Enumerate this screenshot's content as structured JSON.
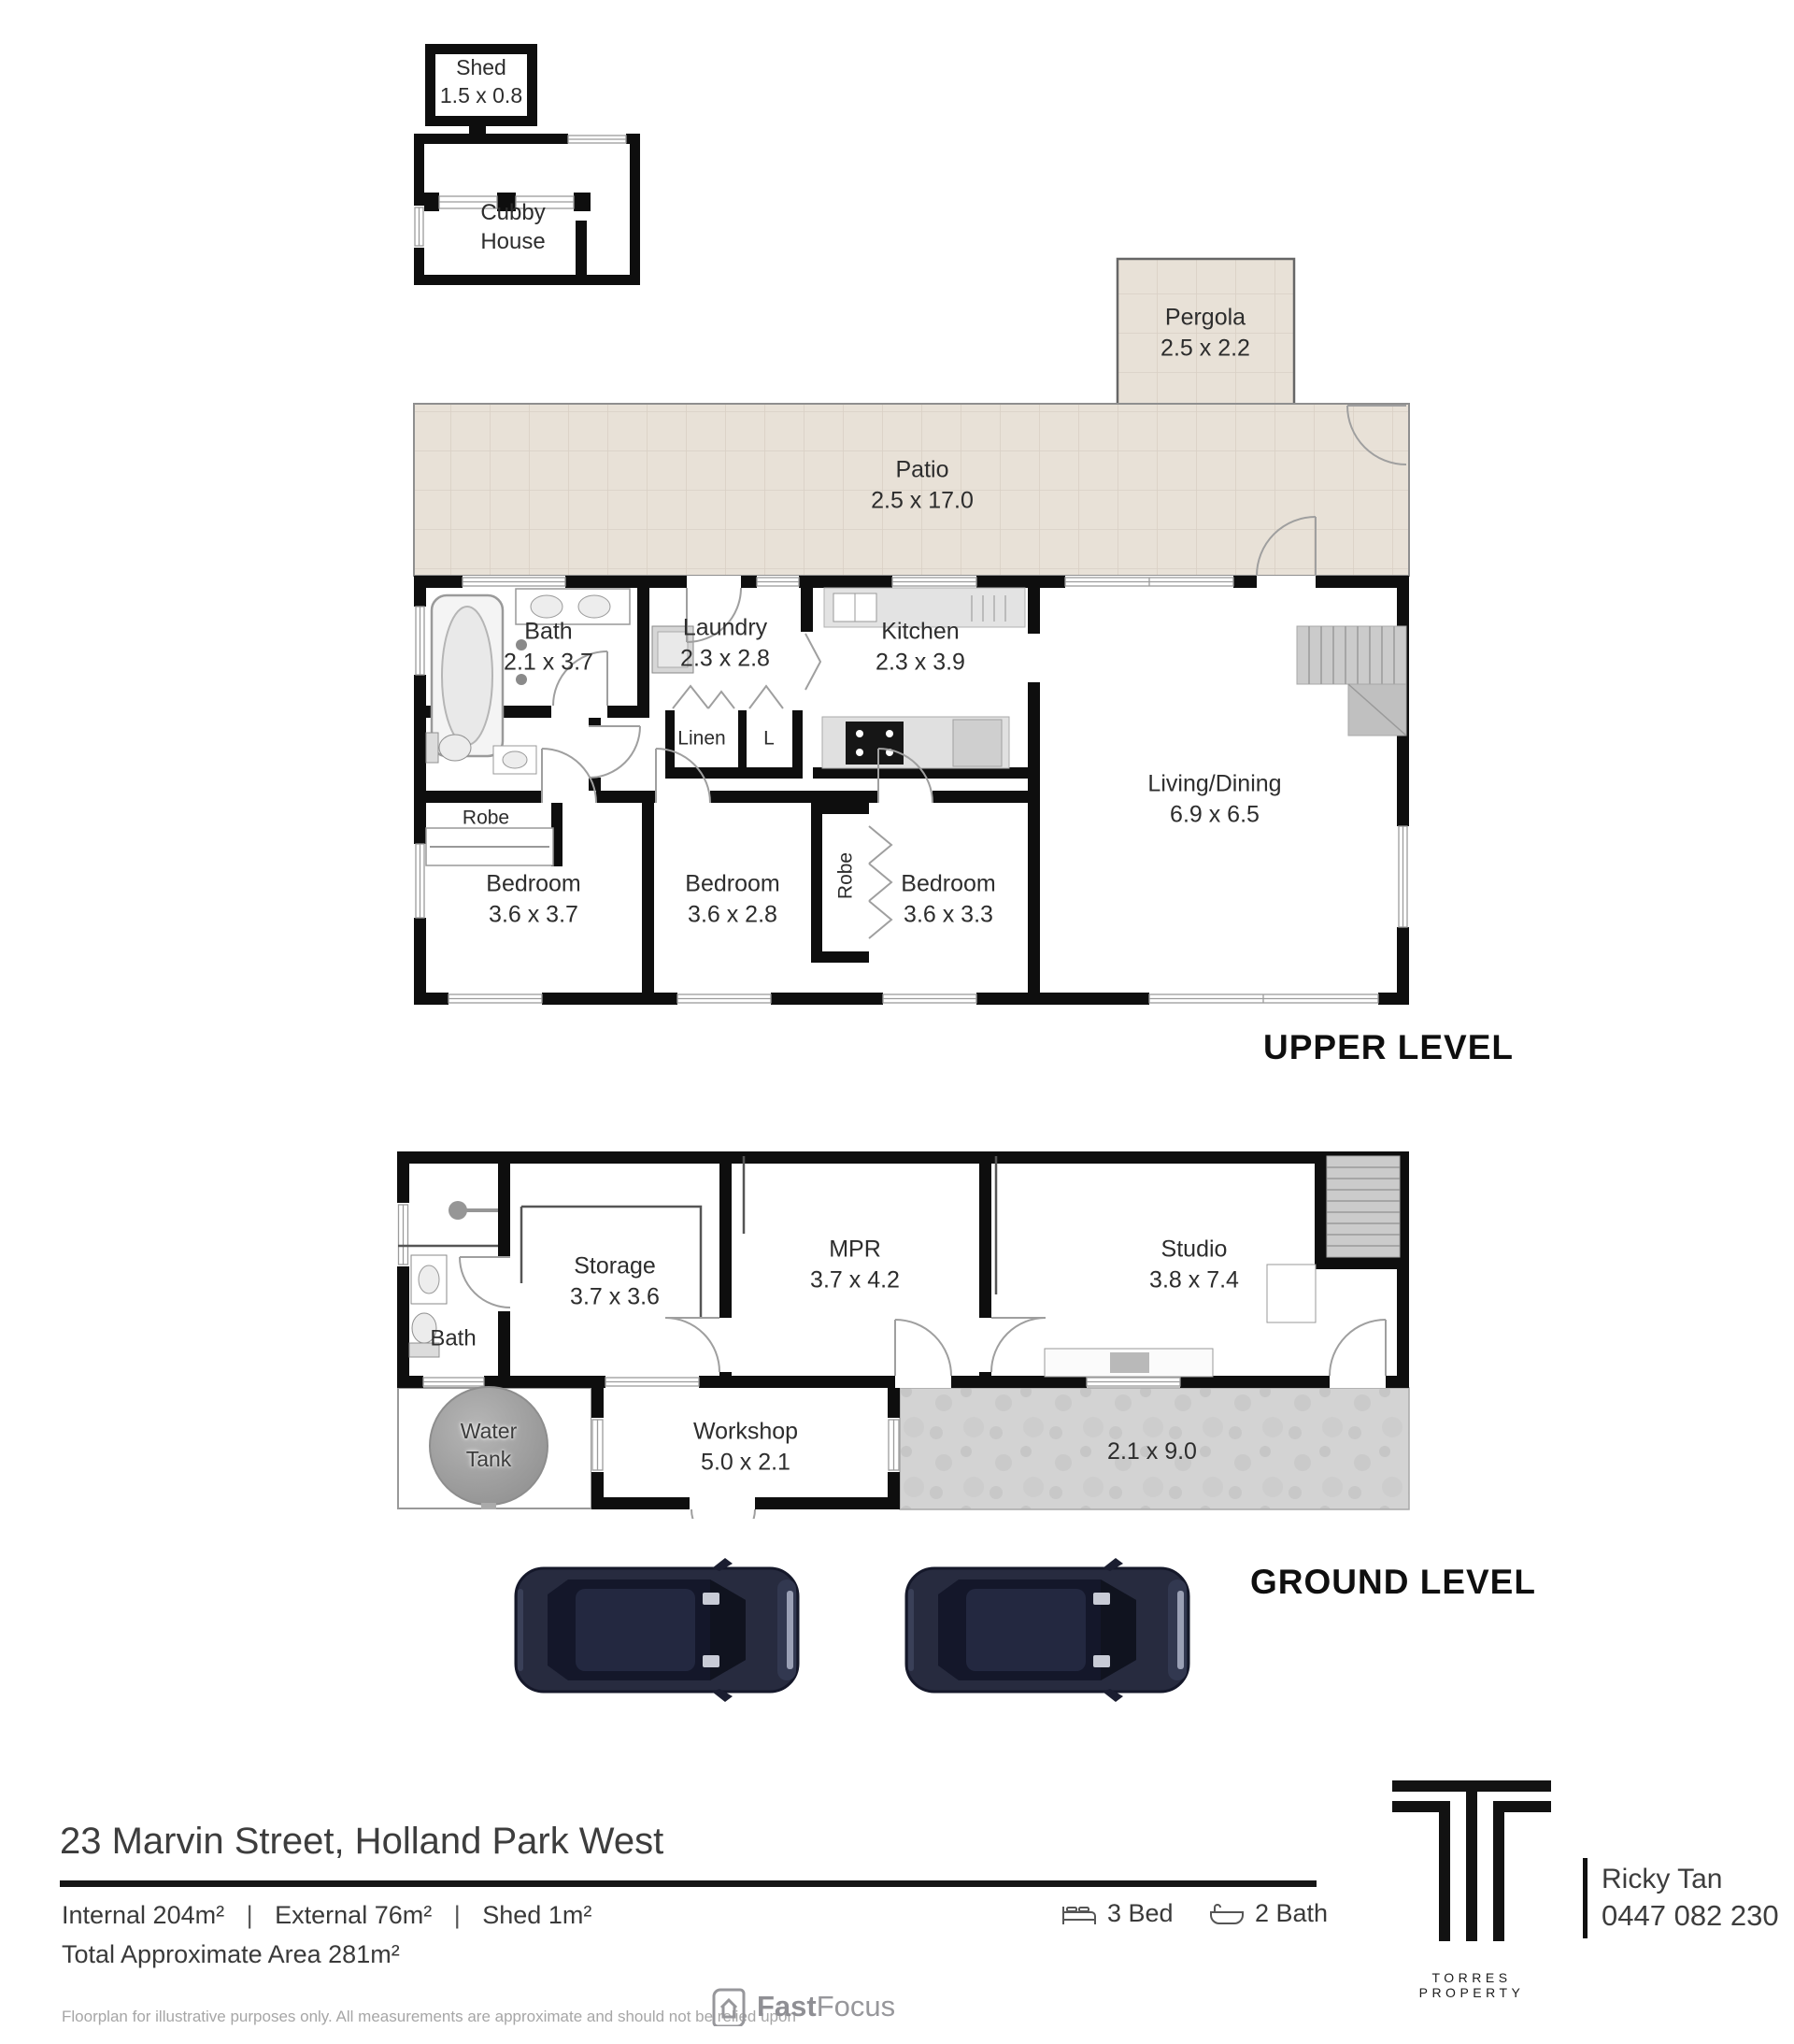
{
  "title": {
    "upper": "UPPER LEVEL",
    "ground": "GROUND LEVEL"
  },
  "outbuildings": {
    "shed": {
      "name": "Shed",
      "dims": "1.5 x 0.8"
    },
    "cubby": {
      "line1": "Cubby",
      "line2": "House"
    }
  },
  "upper": {
    "pergola": {
      "name": "Pergola",
      "dims": "2.5 x 2.2"
    },
    "patio": {
      "name": "Patio",
      "dims": "2.5 x 17.0"
    },
    "bath": {
      "name": "Bath",
      "dims": "2.1 x 3.7"
    },
    "laundry": {
      "name": "Laundry",
      "dims": "2.3 x 2.8"
    },
    "kitchen": {
      "name": "Kitchen",
      "dims": "2.3 x 3.9"
    },
    "linen": {
      "name": "Linen"
    },
    "l_cupboard": {
      "name": "L"
    },
    "robe_nook": {
      "name": "Robe"
    },
    "living": {
      "name": "Living/Dining",
      "dims": "6.9 x 6.5"
    },
    "bedroom1": {
      "name": "Bedroom",
      "dims": "3.6 x 3.7"
    },
    "bedroom2": {
      "name": "Bedroom",
      "dims": "3.6 x 2.8"
    },
    "robe": {
      "name": "Robe"
    },
    "bedroom3": {
      "name": "Bedroom",
      "dims": "3.6 x 3.3"
    }
  },
  "ground": {
    "bath": {
      "name": "Bath"
    },
    "storage": {
      "name": "Storage",
      "dims": "3.7 x 3.6"
    },
    "mpr": {
      "name": "MPR",
      "dims": "3.7 x 4.2"
    },
    "studio": {
      "name": "Studio",
      "dims": "3.8 x 7.4"
    },
    "water_tank": {
      "line1": "Water",
      "line2": "Tank"
    },
    "workshop": {
      "name": "Workshop",
      "dims": "5.0 x 2.1"
    },
    "carport": {
      "dims": "2.1 x 9.0"
    }
  },
  "footer": {
    "address": "23 Marvin Street, Holland Park West",
    "areas": [
      "Internal 204m²",
      "External 76m²",
      "Shed 1m²"
    ],
    "separator": "|",
    "total": "Total Approximate Area 281m²",
    "beds": "3 Bed",
    "baths": "2 Bath",
    "agency": "TORRES PROPERTY",
    "agent": {
      "name": "Ricky Tan",
      "phone": "0447 082 230"
    },
    "disclaimer": "Floorplan for illustrative purposes only. All measurements are approximate and should not be relied upon",
    "brand": {
      "bold": "Fast",
      "light": "Focus"
    }
  }
}
